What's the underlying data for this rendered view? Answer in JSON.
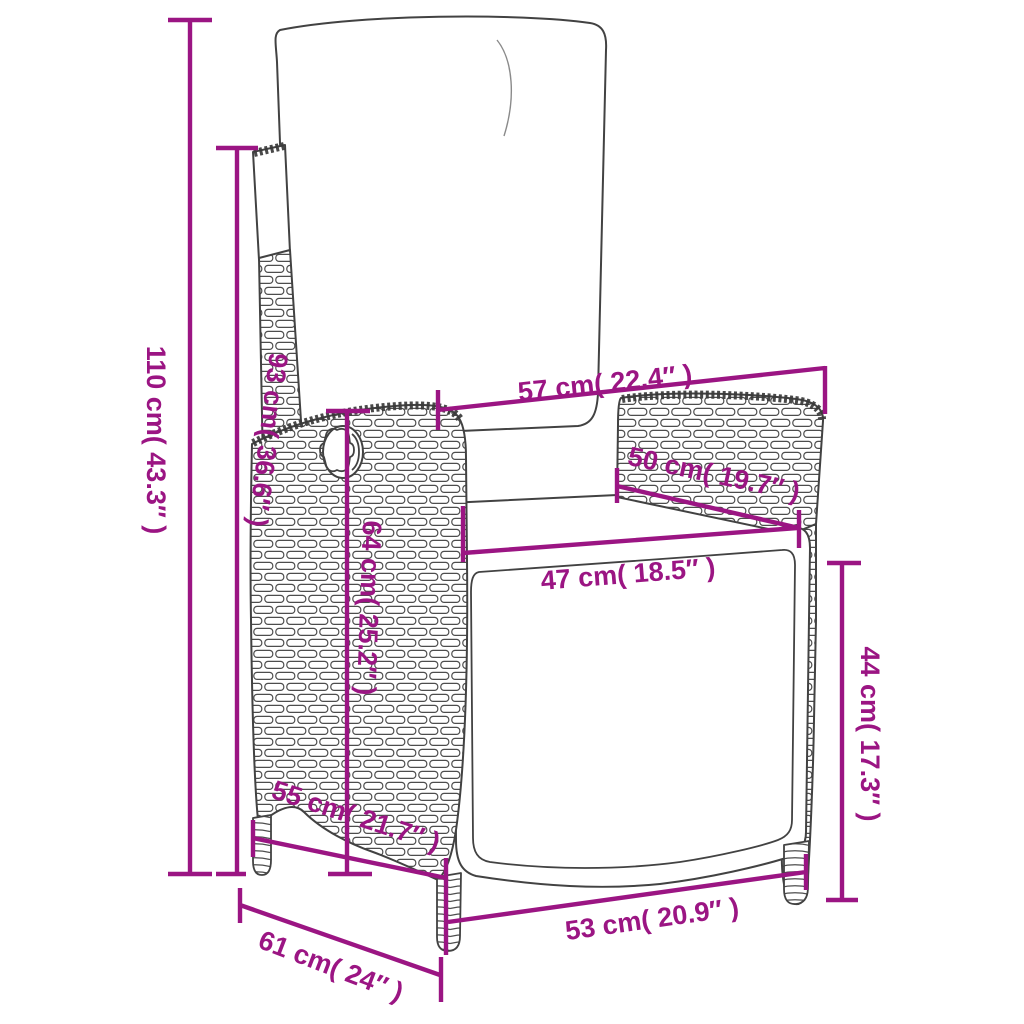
{
  "page": {
    "title": "Reclining rattan garden chair with cushion — dimension diagram"
  },
  "style": {
    "dimension_color": "#9B1583",
    "sketch_color": "#424242",
    "background": "#FFFFFF"
  },
  "dimensions": [
    {
      "name": "overall-height",
      "label": "110 cm( 43.3″ )",
      "cm": 110,
      "inches": 43.3
    },
    {
      "name": "backrest-height",
      "label": "93 cm( 36.6″ )",
      "cm": 93,
      "inches": 36.6
    },
    {
      "name": "armrest-top-width",
      "label": "57 cm( 22.4″ )",
      "cm": 57,
      "inches": 22.4
    },
    {
      "name": "armrest-length",
      "label": "50 cm( 19.7″ )",
      "cm": 50,
      "inches": 19.7
    },
    {
      "name": "seat-front-width",
      "label": "47 cm( 18.5″ )",
      "cm": 47,
      "inches": 18.5
    },
    {
      "name": "armrest-side-height",
      "label": "64 cm( 25.2″ )",
      "cm": 64,
      "inches": 25.2
    },
    {
      "name": "seat-height",
      "label": "44 cm( 17.3″ )",
      "cm": 44,
      "inches": 17.3
    },
    {
      "name": "seat-depth",
      "label": "55 cm( 21.7″ )",
      "cm": 55,
      "inches": 21.7
    },
    {
      "name": "base-front-width",
      "label": "53 cm( 20.9″ )",
      "cm": 53,
      "inches": 20.9
    },
    {
      "name": "overall-depth",
      "label": "61 cm( 24″ )",
      "cm": 61,
      "inches": 24
    }
  ]
}
